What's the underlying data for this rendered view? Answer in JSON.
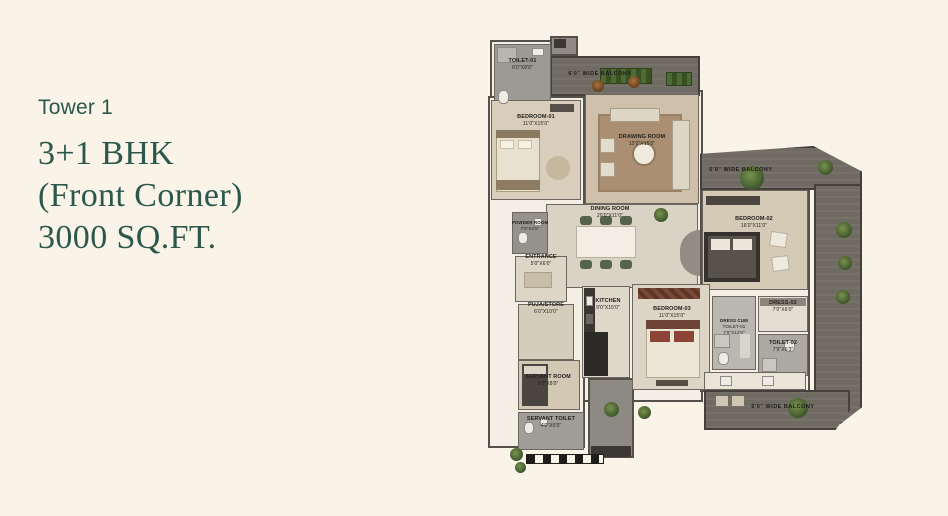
{
  "panel": {
    "tower": "Tower 1",
    "title_line1": "3+1 BHK",
    "title_line2": "(Front Corner)",
    "title_line3": "3000 SQ.FT.",
    "accent_color": "#2b584b"
  },
  "floorplan": {
    "rooms": [
      {
        "name": "TOILET-01",
        "dims": "6'0\"X8'0\""
      },
      {
        "name": "BEDROOM-01",
        "dims": "11'0\"X15'0\""
      },
      {
        "name": "DRAWING ROOM",
        "dims": "12'0\"X15'0\""
      },
      {
        "name": "DINING ROOM",
        "dims": "20'0\"X11'0\""
      },
      {
        "name": "BEDROOM-02",
        "dims": "16'0\"X11'0\""
      },
      {
        "name": "POWDER ROOM",
        "dims": "7'0\"X4'5\""
      },
      {
        "name": "ENTRANCE",
        "dims": "5'0\"X6'0\""
      },
      {
        "name": "PUJA/STORE",
        "dims": "6'0\"X10'0\""
      },
      {
        "name": "KITCHEN",
        "dims": "9'0\"X15'0\""
      },
      {
        "name": "BEDROOM-03",
        "dims": "11'0\"X15'0\""
      },
      {
        "name": "DRESS-02",
        "dims": "7'0\"X6'0\""
      },
      {
        "name": "DRESS CUM",
        "name2": "TOILET-01",
        "dims": "7'0\"X12'0\""
      },
      {
        "name": "TOILET-02",
        "dims": "7'9\"X6'3\""
      },
      {
        "name": "SERVANT ROOM",
        "dims": "6'0\"X8'0\""
      },
      {
        "name": "SERVANT TOILET",
        "dims": "4'0\"X6'0\""
      }
    ],
    "balconies": [
      {
        "label": "6'0\" WIDE BALCONY"
      },
      {
        "label": "6'0\" WIDE BALCONY"
      },
      {
        "label": "6'0\" WIDE BALCONY"
      }
    ]
  }
}
